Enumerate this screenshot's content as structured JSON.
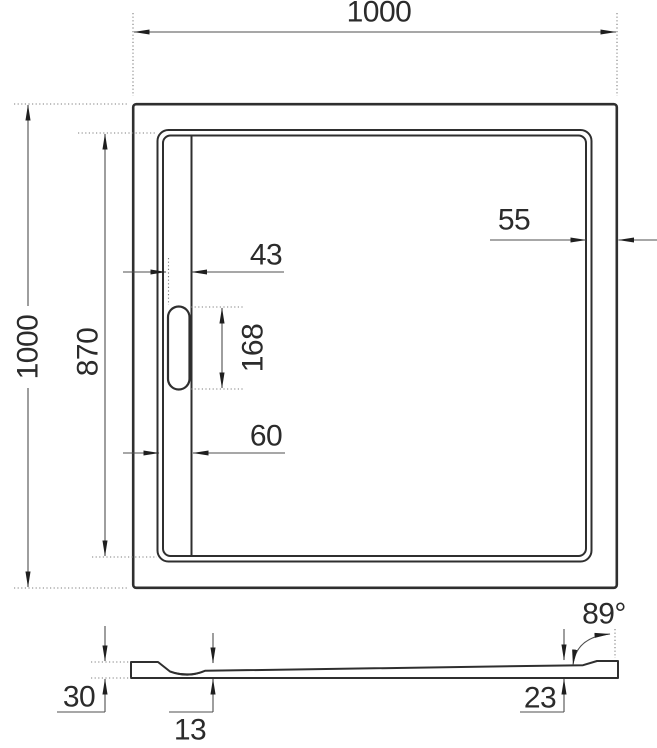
{
  "labels": {
    "overall_width": "1000",
    "overall_depth": "1000",
    "basin_depth": "870",
    "slot_width": "43",
    "slot_length": "168",
    "channel_width": "60",
    "rim_width": "55",
    "profile": {
      "rim_height": "30",
      "base_thickness": "13",
      "edge_height": "23",
      "slope_angle": "89°"
    }
  },
  "colors": {
    "background": "#ffffff",
    "outline": "#2f2f2f",
    "dimension_line": "#4f4f4f",
    "arrow": "#1f1f1f",
    "text": "#2b2b2b"
  }
}
